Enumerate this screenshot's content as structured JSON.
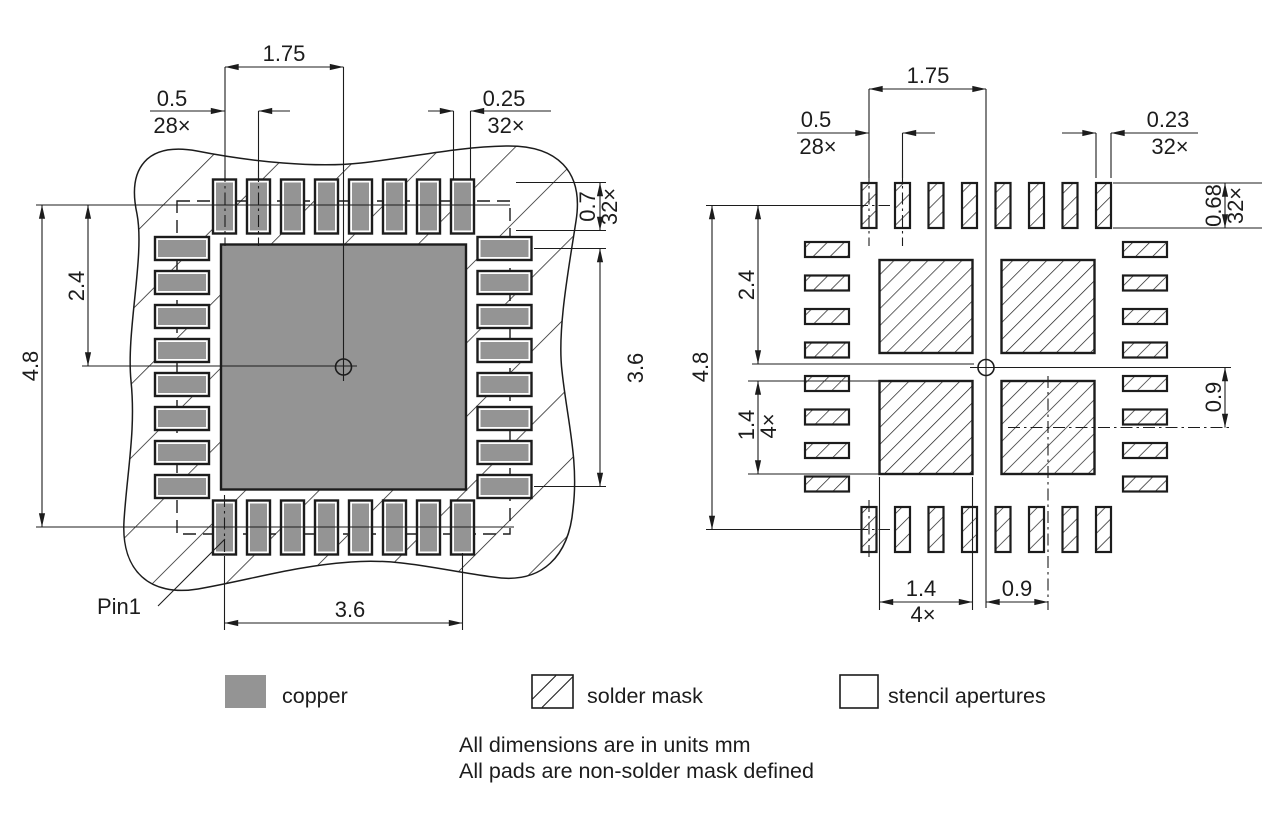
{
  "left_view": {
    "pitch_span": "1.75",
    "pitch": "0.5",
    "pitch_count": "28×",
    "pad_width": "0.25",
    "pad_width_count": "32×",
    "pad_length": "0.7",
    "pad_length_count": "32×",
    "pad_row_span_vertical": "3.6",
    "center_to_top": "2.4",
    "overall_height": "4.8",
    "pad_row_span_horizontal": "3.6",
    "pin1_label": "Pin1"
  },
  "right_view": {
    "pitch_span": "1.75",
    "pitch": "0.5",
    "pitch_count": "28×",
    "aperture_width": "0.23",
    "aperture_width_count": "32×",
    "aperture_length": "0.68",
    "aperture_length_count": "32×",
    "center_to_top": "2.4",
    "overall_height": "4.8",
    "center_aperture_size_v": "1.4",
    "center_aperture_size_v_count": "4×",
    "center_offset_v": "0.9",
    "center_aperture_size_h": "1.4",
    "center_aperture_size_h_count": "4×",
    "center_offset_h": "0.9"
  },
  "legend": {
    "items": [
      {
        "swatch": "copper-swatch",
        "label": "copper"
      },
      {
        "swatch": "solder-mask-swatch",
        "label": "solder mask"
      },
      {
        "swatch": "stencil-apertures-swatch",
        "label": "stencil apertures"
      }
    ]
  },
  "notes": {
    "line1": "All dimensions are in units mm",
    "line2": "All pads are non-solder mask defined"
  },
  "colors": {
    "copper": "#949494",
    "line": "#1c1c1c",
    "background": "#ffffff"
  }
}
